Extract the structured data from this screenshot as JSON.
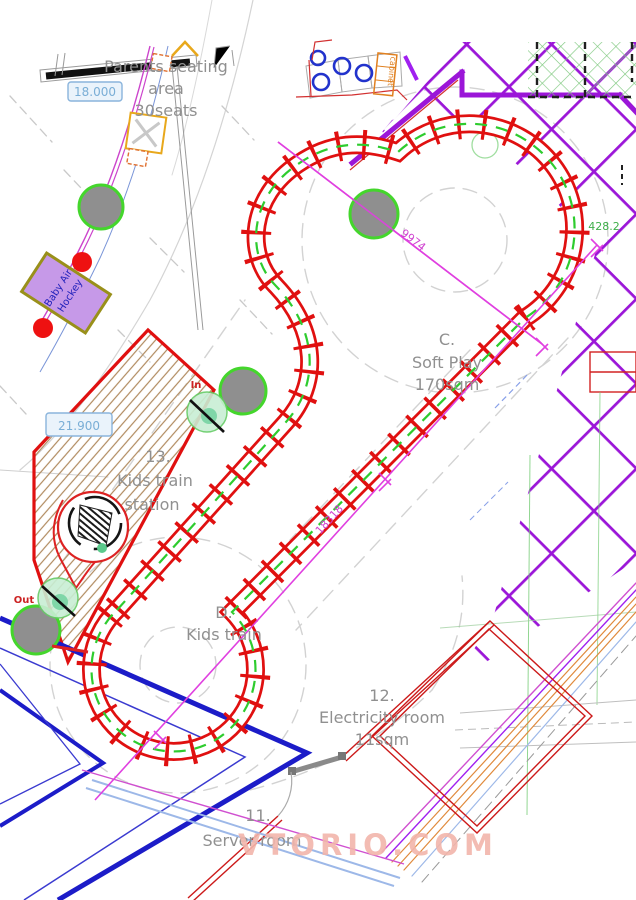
{
  "labels": {
    "parents_seating": {
      "l1": "Parents seating",
      "l2": "area",
      "l3": "30seats"
    },
    "soft_play": {
      "l1": "C.",
      "l2": "Soft Play",
      "l3": "170sqm"
    },
    "kids_train": {
      "l1": "D.",
      "l2": "Kids train"
    },
    "station": {
      "l1": "13.",
      "l2": "Kids train",
      "l3": "station"
    },
    "electricity_room": {
      "l1": "12.",
      "l2": "Electricity room",
      "l3": "11sqm"
    },
    "server_room": {
      "l1": "11.",
      "l2": "Server room"
    },
    "baby_air_hockey": {
      "l1": "Baby Air",
      "l2": "Hockey"
    },
    "cabinet": "cabinet",
    "gate_in": "In",
    "gate_out": "Out"
  },
  "dimensions": {
    "d_18000": "18.000",
    "d_21900": "21.900",
    "d_9974": "9974",
    "d_18318": "18318",
    "d_428": "428.2"
  },
  "watermark": "VTORIO.COM",
  "colors": {
    "track_red": "#e01010",
    "rail_green": "#2ecc2e",
    "grid_purple": "#9b16d8",
    "dim_magenta": "#d043d0",
    "wall_red": "#cc1a1a",
    "platform_hatch": "#b08a5e",
    "tree_fill": "#8f8f8f",
    "tree_stroke": "#44d62c",
    "dim_blue": "#7aaed6",
    "orange": "#e08a3c",
    "struct_blue": "#1c1cc8",
    "watermark_pink": "#f2b5ab"
  }
}
